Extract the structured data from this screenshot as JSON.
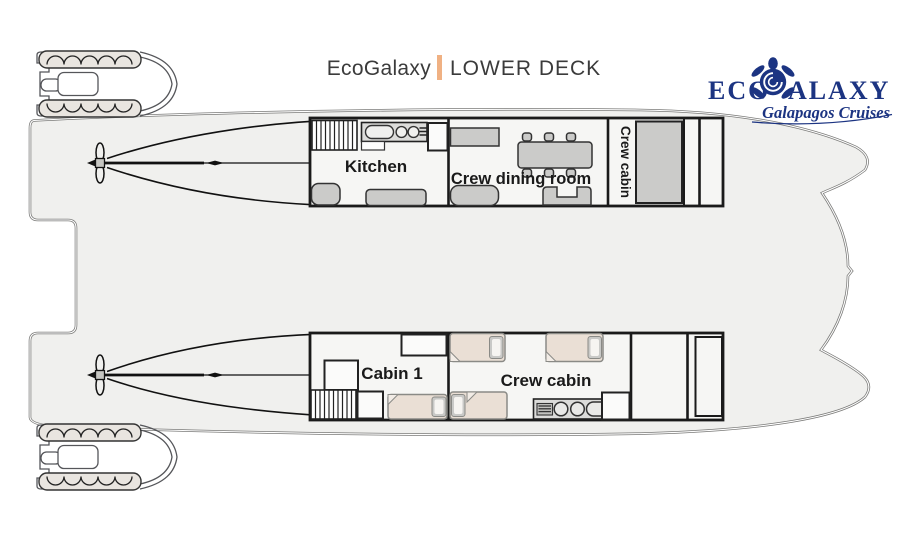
{
  "title": {
    "brand": "EcoGalaxy",
    "separator": "|",
    "deck_name": "LOWER DECK"
  },
  "logo": {
    "word_start": "ECO",
    "word_end": "ALAXY",
    "tagline": "Galapagos Cruises",
    "mark": "turtle-icon"
  },
  "rooms": {
    "kitchen": "Kitchen",
    "crew_dining_room": "Crew dining room",
    "crew_cabin_upper": "Crew cabin",
    "cabin_1": "Cabin 1",
    "crew_cabin_lower": "Crew cabin"
  },
  "colors": {
    "logo_navy": "#1c3482",
    "accent_orange": "#f0b183",
    "deck_fill": "#f0f0ee",
    "room_fill": "#f6f6f4",
    "furniture_gray": "#cbcbc9",
    "bed_beige": "#eadfd5",
    "wall_black": "#1a1a1a"
  }
}
